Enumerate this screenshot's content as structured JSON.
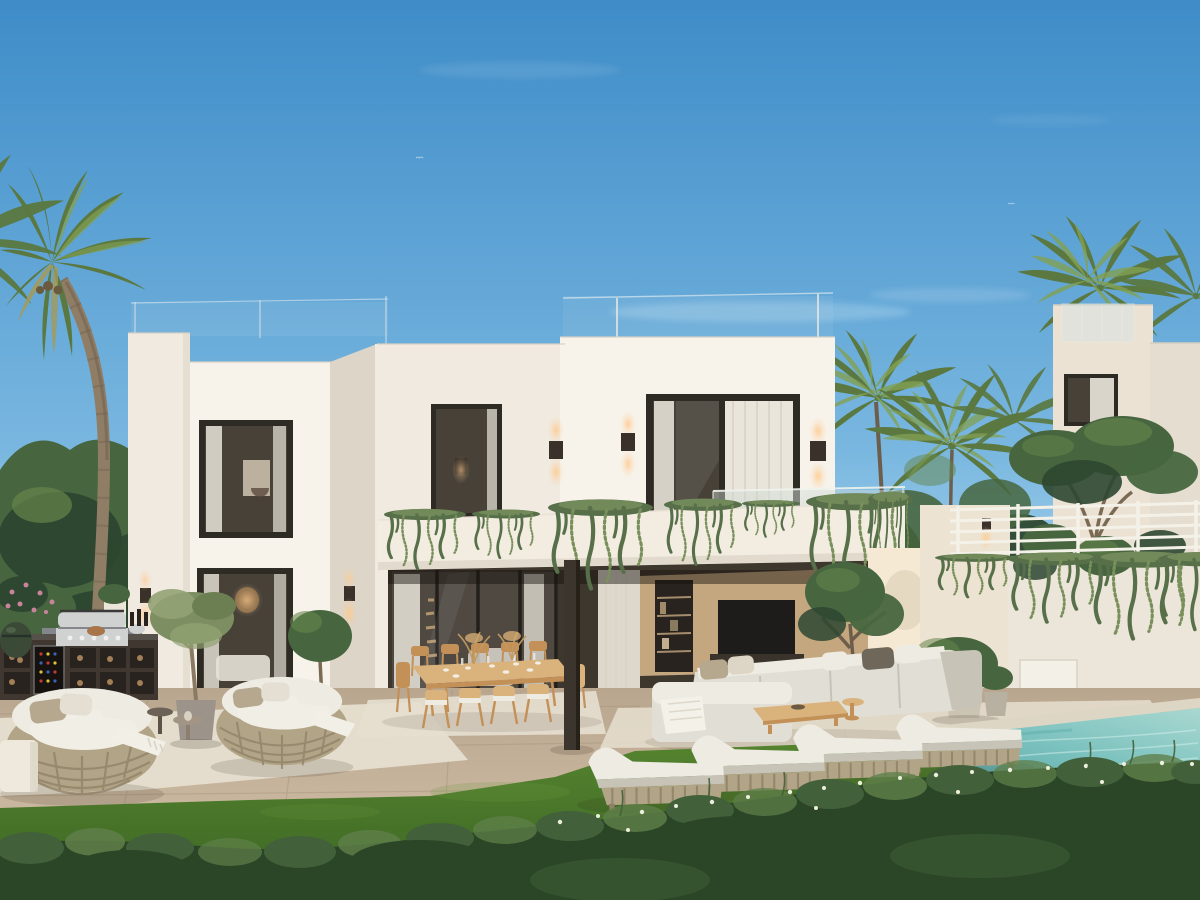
{
  "image": {
    "kind": "3D architectural exterior rendering (photoreal)",
    "subject": "Modern two-storey white cubist villa with garden terrace, outdoor furniture and pool",
    "time_of_day": "dusk, clear sky, warm facade lights switched on",
    "width_px": 1200,
    "height_px": 900
  },
  "palette": {
    "sky_top": "#3e8cc8",
    "sky_mid": "#79b7e0",
    "sky_low": "#c2e1ef",
    "cloud": "#eaf4f9",
    "trees_dark": "#2d4730",
    "trees_mid": "#47663f",
    "trees_light": "#66854c",
    "palm_leaf": "#5a7840",
    "palm_leaf_light": "#83a052",
    "palm_leaf_dry": "#a49a58",
    "palm_trunk": "#8f7d66",
    "palm_trunk_dark": "#6d5e4c",
    "wall_bright": "#f7f3eb",
    "wall_white": "#f0eae0",
    "wall_band": "#f3ede1",
    "wall_shade": "#ddd5c7",
    "wall_warm": "#f6e9d3",
    "wall_neutral": "#ebe2d4",
    "frame_dark": "#2e2a24",
    "glass_dark": "#474138",
    "glass_mid": "#5c5a54",
    "curtain": "#eae5da",
    "interior_tan": "#c4a67f",
    "interior_dark": "#3e372e",
    "tv_black": "#1d1c1a",
    "balustrade": "#ccd9d3",
    "plant_green": "#57704a",
    "plant_green_light": "#79905c",
    "sconce_dark": "#3a322a",
    "glow": "#ffca8f",
    "patio_front": "#d6c3ac",
    "patio_back": "#b9a68e",
    "rug": "#e6dfd0",
    "grass_top": "#55842f",
    "grass_deep": "#3a6423",
    "grass_light": "#6f9c42",
    "hedge_dark": "#2b4527",
    "hedge_mid": "#42613a",
    "hedge_light": "#5f7f4a",
    "flower_white": "#edefdd",
    "flower_pink": "#c9839a",
    "pool_light": "#a9d8d0",
    "pool_main": "#7cc2bf",
    "pool_deep": "#58a7a6",
    "pool_edge_far": "#ded6c4",
    "pool_edge_near": "#92887a",
    "wood": "#c39158",
    "wood_light": "#dab37c",
    "sofa": "#e1ded5",
    "sofa_dark": "#c7c3b7",
    "cushion": "#eeebe2",
    "cushion_taupe": "#b5a88f",
    "wicker": "#b2a487",
    "wicker_dark": "#8f8166",
    "steel": "#d0d2d2",
    "steel_dark": "#83868a",
    "kitchen_dark": "#403830",
    "kitchen_deep": "#292320",
    "kamado_green": "#3a4a36",
    "fence_white": "#f4f1e8"
  },
  "scene": {
    "sky": {
      "clouds": "faint wisps above the roofline",
      "birds_visible": 3
    },
    "vegetation": {
      "foreground_palm_trees": 1,
      "background": "dense green trees on the left, tall palms between the villas",
      "stone_pine_topiary_right": 2,
      "trailing_plants": "draped over balcony parapet and right retaining wall",
      "flowering_hedge_foreground": true
    },
    "main_villa": {
      "storeys": 2,
      "style": "white flat-roof cubist volumes",
      "roof_railing": "frameless glass with thin posts",
      "upper_windows": 3,
      "lit_wall_sconces": 5,
      "balcony": "white parapet band with trailing greenery",
      "upper_terrace_railing": "frosted glass",
      "ground_floor": "open glass living room with TV wall, bookshelf and sheer curtains, interior staircase glimpse"
    },
    "neighbour_villa": {
      "position": "right background",
      "roof": "glass-railed terrace with palm behind",
      "windows": 1,
      "white_horizontal_rail_fence": true
    },
    "terrace": {
      "outdoor_kitchen": {
        "bbq_grill": 1,
        "wine_fridge": 1,
        "kamado_grill": 1,
        "log_storage_cubbies": true,
        "pots_and_bottles": true
      },
      "round_wicker_daybeds": 2,
      "side_tables": 3,
      "potted_olive_trees": 2,
      "dining_table": {
        "material": "light wood",
        "seats": 10,
        "set_with": "glassware, plates, pampas centerpieces"
      },
      "lounge_sofa": "L-shaped light grey modular with cushions and throw",
      "coffee_table": "low wooden slab",
      "sun_loungers": 4,
      "area_rugs": 3,
      "dark_support_column": 1
    },
    "garden": {
      "lawn": true,
      "grass_between_patio_and_hedge": true
    },
    "pool": {
      "water": "turquoise",
      "position": "bottom right",
      "edge": "stone coping"
    }
  }
}
